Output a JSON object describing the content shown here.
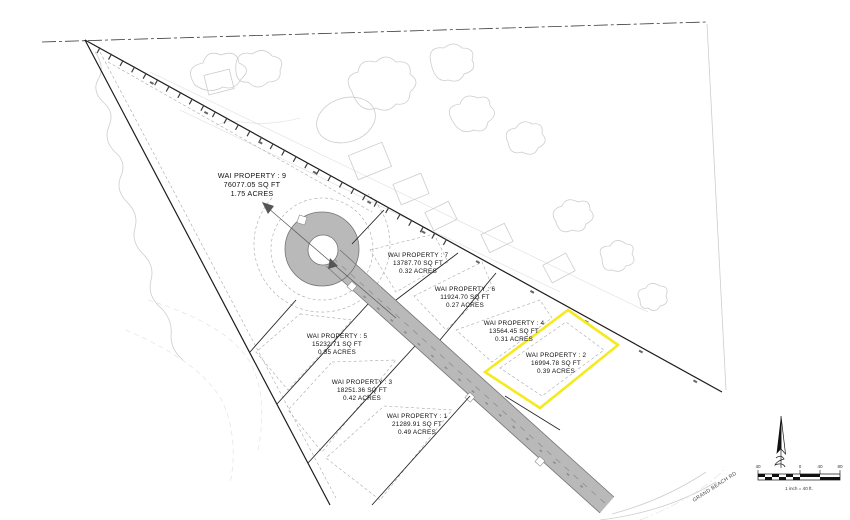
{
  "drawing": {
    "lots": [
      {
        "name": "WAI PROPERTY : 9",
        "sqft": "76077.05 SQ FT",
        "acres": "1.75 ACRES"
      },
      {
        "name": "WAI PROPERTY : 7",
        "sqft": "13787.70 SQ FT",
        "acres": "0.32 ACRES"
      },
      {
        "name": "WAI PROPERTY : 6",
        "sqft": "11924.70 SQ FT",
        "acres": "0.27 ACRES"
      },
      {
        "name": "WAI PROPERTY : 4",
        "sqft": "13564.45 SQ FT",
        "acres": "0.31 ACRES"
      },
      {
        "name": "WAI PROPERTY : 2",
        "sqft": "16994.78 SQ FT",
        "acres": "0.39 ACRES"
      },
      {
        "name": "WAI PROPERTY : 5",
        "sqft": "15232.71 SQ FT",
        "acres": "0.35 ACRES"
      },
      {
        "name": "WAI PROPERTY : 3",
        "sqft": "18251.36 SQ FT",
        "acres": "0.42 ACRES"
      },
      {
        "name": "WAI PROPERTY : 1",
        "sqft": "21289.91 SQ FT",
        "acres": "0.49 ACRES"
      }
    ],
    "road_label": "GRAND BEACH RD",
    "scale_bar": {
      "caption": "1 inch = 40 ft.",
      "ticks": [
        "40",
        "0",
        "40",
        "80"
      ]
    },
    "highlight": {
      "lot": "WAI PROPERTY : 2",
      "color": "#f4ea1f"
    },
    "colors": {
      "road_fill": "#b9b9b9",
      "line": "#1c1c1c",
      "faint": "#cccccc"
    }
  }
}
